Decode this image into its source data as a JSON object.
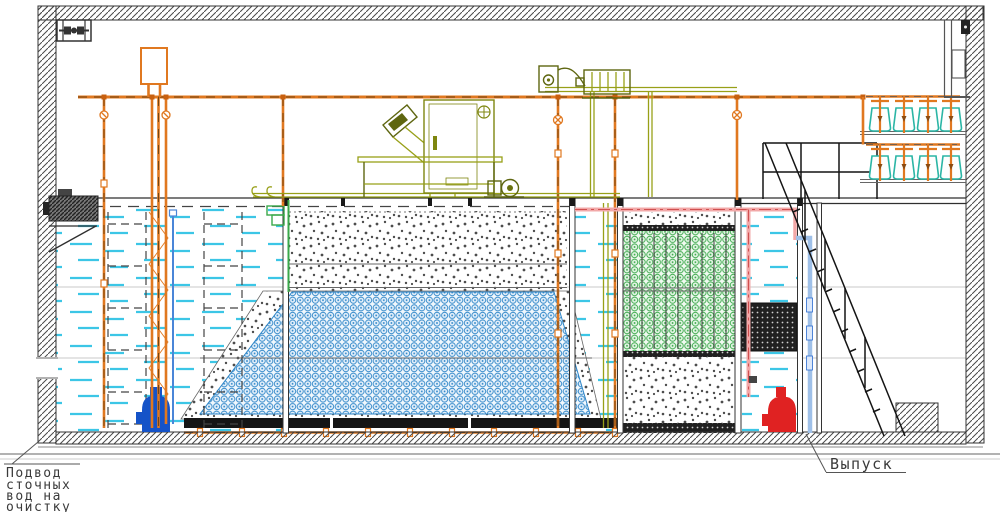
{
  "drawing": {
    "kind": "wastewater-treatment-plant-section",
    "labels": {
      "inlet_lines": [
        "Подвод",
        "сточных",
        "вод на",
        "очистку"
      ],
      "outlet": "Выпуск"
    },
    "elements": {
      "top_left_icon": "ventilation-fan-icon",
      "left_equipment": "wall-mounted-motor",
      "tanks": [
        "receiving-tank",
        "aeration-tank-with-media",
        "biofilter-tank",
        "clarifier-tank"
      ],
      "pumps": [
        "submersible-pump-blue",
        "submersible-pump-red"
      ],
      "top_equipment": [
        "screen-unit",
        "control-cabinet",
        "blower",
        "pump-unit",
        "dosing-vessel-shelves"
      ],
      "access": [
        "service-platform-railing",
        "staircase"
      ]
    }
  },
  "palette": {
    "line_dark": "#2f2f2f",
    "wall_hatch": "#4a4a4a",
    "pipe_orange": "#e07820",
    "pipe_pink": "#f2a8a8",
    "pipe_pink_dash": "#d05050",
    "pipe_light_blue": "#9fc0e8",
    "equipment_olive": "#98a018",
    "water_cyan": "#3cc6e6",
    "media_blue": "#2e86c8",
    "media_green": "#3aa84a",
    "vessel_teal": "#2ab5a5",
    "pump_blue": "#1553c8",
    "pump_red": "#e02222"
  }
}
